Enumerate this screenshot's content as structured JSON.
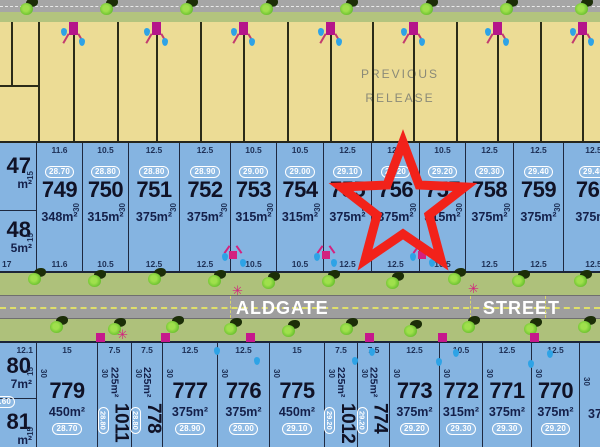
{
  "header": {
    "previous_release_line1": "PREVIOUS",
    "previous_release_line2": "RELEASE"
  },
  "street": {
    "word1": "ALDGATE",
    "word2": "STREET"
  },
  "star": {
    "marked_lot": "756",
    "color": "#f2221a"
  },
  "colors": {
    "lot_blue": "#85b4e1",
    "lot_yellow": "#ecdc95",
    "road_gray": "#9e9e9e",
    "verge_green": "#aec17b",
    "marker_magenta": "#c6188c",
    "drop_blue": "#2ea3e6",
    "tree_green": "#6cc230",
    "star_red": "#f2221a",
    "badge_white": "#ffffff"
  },
  "top_row": {
    "partial_left": {
      "upper": {
        "number": "47",
        "area": "m²",
        "side": "15",
        "badge_fragment": "0"
      },
      "lower": {
        "number": "48",
        "area": "5m²",
        "side": "15",
        "badge_fragment": "0",
        "corner_dim": "17"
      }
    },
    "lots": [
      {
        "number": "749",
        "badge": "28.70",
        "area": "348m²",
        "top": "11.6",
        "bottom": "11.6",
        "depth": "30",
        "w": 46
      },
      {
        "number": "750",
        "badge": "28.80",
        "area": "315m²",
        "top": "10.5",
        "bottom": "10.5",
        "depth": "30",
        "w": 46
      },
      {
        "number": "751",
        "badge": "28.80",
        "area": "375m²",
        "top": "12.5",
        "bottom": "12.5",
        "depth": "30",
        "w": 51
      },
      {
        "number": "752",
        "badge": "28.90",
        "area": "375m²",
        "top": "12.5",
        "bottom": "12.5",
        "depth": "30",
        "w": 51
      },
      {
        "number": "753",
        "badge": "29.00",
        "area": "315m²",
        "top": "10.5",
        "bottom": "10.5",
        "depth": "30",
        "w": 46
      },
      {
        "number": "754",
        "badge": "29.00",
        "area": "315m²",
        "top": "10.5",
        "bottom": "10.5",
        "depth": "30",
        "w": 47
      },
      {
        "number": "755",
        "badge": "29.10",
        "area": "375m²",
        "top": "12.5",
        "bottom": "12.5",
        "depth": "30",
        "w": 48
      },
      {
        "number": "756",
        "badge": "29.20",
        "area": "375m²",
        "top": "12.5",
        "bottom": "12.5",
        "depth": "30",
        "w": 48,
        "starred": true
      },
      {
        "number": "757",
        "badge": "29.20",
        "area": "315m²",
        "top": "10.5",
        "bottom": "10.5",
        "depth": "30",
        "w": 46
      },
      {
        "number": "758",
        "badge": "29.30",
        "area": "375m²",
        "top": "12.5",
        "bottom": "12.5",
        "depth": "30",
        "w": 48
      },
      {
        "number": "759",
        "badge": "29.40",
        "area": "375m²",
        "top": "12.5",
        "bottom": "12.5",
        "depth": "30",
        "w": 50
      },
      {
        "number": "760",
        "badge": "29.40",
        "area": "375m²",
        "top": "12.5",
        "bottom": "12.5",
        "depth": "30",
        "w": 60,
        "partial": true
      }
    ]
  },
  "bottom_row": {
    "partial_left": {
      "upper": {
        "dim": "12.1",
        "number": "80",
        "area": "7m²",
        "side": "15",
        "badge": "28.60"
      },
      "lower": {
        "number": "81",
        "area": "m²",
        "side": "15"
      }
    },
    "lots": [
      {
        "number": "779",
        "badge": "28.70",
        "area": "450m²",
        "top": "15",
        "depth": "30",
        "w": 61
      },
      {
        "number": "1011",
        "badge": "28.80",
        "area": "225m²",
        "top": "7.5",
        "depth": "30",
        "w": 34,
        "narrow": true
      },
      {
        "number": "778",
        "badge": "28.80",
        "area": "225m²",
        "top": "7.5",
        "depth": "30",
        "w": 31,
        "narrow": true
      },
      {
        "number": "777",
        "badge": "28.90",
        "area": "375m²",
        "top": "12.5",
        "depth": "30",
        "w": 55
      },
      {
        "number": "776",
        "badge": "29.00",
        "area": "375m²",
        "top": "12.5",
        "depth": "30",
        "w": 52
      },
      {
        "number": "775",
        "badge": "29.10",
        "area": "450m²",
        "top": "15",
        "depth": "30",
        "w": 55
      },
      {
        "number": "1012",
        "badge": "29.20",
        "area": "225m²",
        "top": "7.5",
        "depth": "30",
        "w": 33,
        "narrow": true
      },
      {
        "number": "774",
        "badge": "29.20",
        "area": "225m²",
        "top": "7.5",
        "depth": "30",
        "w": 32,
        "narrow": true
      },
      {
        "number": "773",
        "badge": "29.20",
        "area": "375m²",
        "top": "12.5",
        "depth": "30",
        "w": 50
      },
      {
        "number": "772",
        "badge": "29.30",
        "area": "315m²",
        "top": "10.5",
        "depth": "30",
        "w": 43
      },
      {
        "number": "771",
        "badge": "29.30",
        "area": "375m²",
        "top": "12.5",
        "depth": "30",
        "w": 49
      },
      {
        "number": "770",
        "badge": "29.20",
        "area": "375m²",
        "top": "12.5",
        "depth": "30",
        "w": 48
      }
    ],
    "partial_right": {
      "depth": "30",
      "area": "375m²"
    }
  },
  "decorations": {
    "yellow_boundary_lines": [
      38,
      117,
      200,
      287,
      372,
      456,
      540
    ],
    "yellow_marker_lines": [
      73,
      156,
      243,
      330,
      413,
      497,
      582
    ],
    "corner_lot": {
      "h_y": 63,
      "v_x": 11
    },
    "trees_top": [
      20,
      100,
      180,
      260,
      340,
      420,
      500,
      575
    ],
    "trees_upper_verge": [
      [
        28,
        270
      ],
      [
        88,
        272
      ],
      [
        148,
        270
      ],
      [
        208,
        272
      ],
      [
        262,
        274
      ],
      [
        322,
        272
      ],
      [
        386,
        274
      ],
      [
        448,
        270
      ],
      [
        512,
        272
      ],
      [
        574,
        272
      ]
    ],
    "trees_lower_verge": [
      [
        50,
        318
      ],
      [
        108,
        320
      ],
      [
        166,
        318
      ],
      [
        224,
        320
      ],
      [
        282,
        322
      ],
      [
        340,
        320
      ],
      [
        404,
        322
      ],
      [
        462,
        318
      ],
      [
        524,
        320
      ],
      [
        578,
        318
      ]
    ],
    "street_lights": [
      [
        232,
        284
      ],
      [
        468,
        282
      ],
      [
        117,
        328
      ]
    ],
    "hydrant_figures": [
      [
        229,
        251
      ],
      [
        322,
        251
      ],
      [
        418,
        251
      ]
    ],
    "corner_squares": [
      [
        96,
        333
      ],
      [
        161,
        333
      ],
      [
        246,
        333
      ],
      [
        365,
        333
      ],
      [
        438,
        333
      ],
      [
        530,
        333
      ]
    ],
    "water_drops": [
      [
        222,
        253
      ],
      [
        240,
        259
      ],
      [
        314,
        253
      ],
      [
        331,
        259
      ],
      [
        410,
        253
      ],
      [
        429,
        259
      ],
      [
        214,
        347
      ],
      [
        254,
        357
      ],
      [
        352,
        357
      ],
      [
        369,
        348
      ],
      [
        436,
        358
      ],
      [
        453,
        349
      ],
      [
        528,
        360
      ],
      [
        547,
        350
      ]
    ],
    "road_cross_dashes": [
      230,
      470,
      545
    ]
  }
}
